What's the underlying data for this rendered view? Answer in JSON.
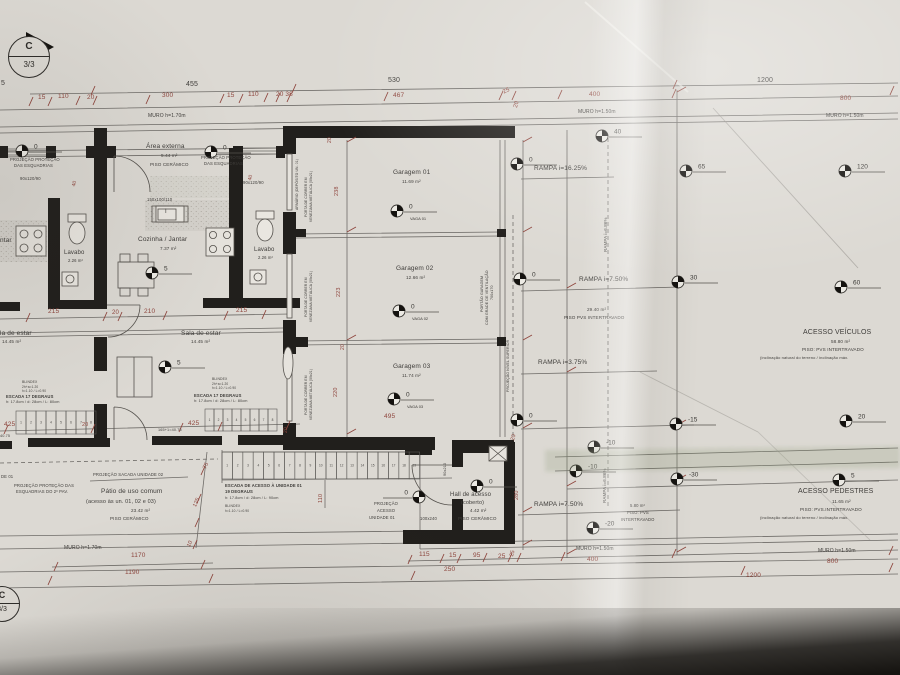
{
  "palette": {
    "paper": "#dcd9d3",
    "ink": "#3f3d3a",
    "red": "#94453c",
    "wall": "#1e1c19",
    "line": "#6e6b67"
  },
  "section_marker": {
    "top": "C",
    "bottom": "3/3"
  },
  "markers": [
    {
      "x": 22,
      "y": 151,
      "v": "0"
    },
    {
      "x": 211,
      "y": 152,
      "v": "0"
    },
    {
      "x": 152,
      "y": 273,
      "v": "5"
    },
    {
      "x": 165,
      "y": 367,
      "v": "5"
    },
    {
      "x": 397,
      "y": 211,
      "v": "0",
      "sub": "VAGA 01"
    },
    {
      "x": 399,
      "y": 311,
      "v": "0",
      "sub": "VAGA 02"
    },
    {
      "x": 394,
      "y": 399,
      "v": "0",
      "sub": "VAGA 03"
    },
    {
      "x": 517,
      "y": 164,
      "v": "0"
    },
    {
      "x": 602,
      "y": 136,
      "v": "40"
    },
    {
      "x": 686,
      "y": 171,
      "v": "65"
    },
    {
      "x": 845,
      "y": 171,
      "v": "120"
    },
    {
      "x": 520,
      "y": 279,
      "v": "0"
    },
    {
      "x": 678,
      "y": 282,
      "v": "30"
    },
    {
      "x": 841,
      "y": 287,
      "v": "60"
    },
    {
      "x": 517,
      "y": 420,
      "v": "0"
    },
    {
      "x": 676,
      "y": 424,
      "v": "-15"
    },
    {
      "x": 846,
      "y": 421,
      "v": "20"
    },
    {
      "x": 594,
      "y": 447,
      "v": "-10"
    },
    {
      "x": 576,
      "y": 471,
      "v": "-10"
    },
    {
      "x": 677,
      "y": 479,
      "v": "-30"
    },
    {
      "x": 839,
      "y": 480,
      "v": "5"
    },
    {
      "x": 593,
      "y": 528,
      "v": "-20"
    },
    {
      "x": 477,
      "y": 486,
      "v": "0"
    },
    {
      "x": 419,
      "y": 497,
      "v": "0",
      "dir": -1
    }
  ],
  "stairs": {
    "runs": [
      {
        "x": 16,
        "y": 411,
        "w": 10,
        "h": 23,
        "count": 8
      },
      {
        "x": 205,
        "y": 409,
        "w": 9,
        "h": 22,
        "count": 8
      },
      {
        "x": 222,
        "y": 452,
        "w": 10.4,
        "h": 27,
        "count": 19
      }
    ]
  },
  "labels": [
    {
      "n": "dim-total-455",
      "t": "455",
      "x": 186,
      "y": 81,
      "s": 7
    },
    {
      "n": "dim-total-530",
      "t": "530",
      "x": 388,
      "y": 77,
      "s": 7
    },
    {
      "n": "dim-total-1200",
      "t": "1200",
      "x": 757,
      "y": 77,
      "s": 7
    },
    {
      "n": "dim",
      "t": "15",
      "x": 38,
      "y": 95,
      "s": 6.5,
      "c": "r"
    },
    {
      "n": "dim",
      "t": "110",
      "x": 58,
      "y": 94,
      "s": 6.5,
      "c": "r"
    },
    {
      "n": "dim",
      "t": "20",
      "x": 87,
      "y": 95,
      "s": 6.5,
      "c": "r"
    },
    {
      "n": "dim",
      "t": "300",
      "x": 162,
      "y": 93,
      "s": 6.5,
      "c": "r"
    },
    {
      "n": "dim",
      "t": "15",
      "x": 227,
      "y": 93,
      "s": 6.5,
      "c": "r"
    },
    {
      "n": "dim",
      "t": "110",
      "x": 248,
      "y": 92,
      "s": 6.5,
      "c": "r"
    },
    {
      "n": "dim",
      "t": "20 38",
      "x": 276,
      "y": 92,
      "s": 6.5,
      "c": "r"
    },
    {
      "n": "dim",
      "t": "467",
      "x": 393,
      "y": 93,
      "s": 6.5,
      "c": "r"
    },
    {
      "n": "dim",
      "t": "25",
      "x": 502,
      "y": 90,
      "s": 6,
      "c": "r",
      "r": -25
    },
    {
      "n": "dim",
      "t": "20",
      "x": 513,
      "y": 107,
      "s": 6,
      "c": "r",
      "r": -75
    },
    {
      "n": "dim",
      "t": "400",
      "x": 589,
      "y": 92,
      "s": 6.5,
      "c": "r"
    },
    {
      "n": "dim",
      "t": "800",
      "x": 840,
      "y": 96,
      "s": 6.5,
      "c": "r"
    },
    {
      "n": "wall-note",
      "t": "MURO h=1.70m",
      "x": 148,
      "y": 114,
      "s": 5
    },
    {
      "n": "wall-note",
      "t": "MURO h=1.50m",
      "x": 578,
      "y": 110,
      "s": 5
    },
    {
      "n": "wall-note",
      "t": "MURO h=1.50m",
      "x": 826,
      "y": 114,
      "s": 5
    },
    {
      "n": "dim-fragment",
      "t": "5",
      "x": 1,
      "y": 80,
      "s": 7
    },
    {
      "n": "note",
      "t": "PROJEÇÃO PROTEÇÃO",
      "x": 10,
      "y": 158,
      "s": 4.2
    },
    {
      "n": "note",
      "t": "DAS ESQUADRIAS",
      "x": 14,
      "y": 164,
      "s": 4.2
    },
    {
      "n": "window-code",
      "t": "90x120/90",
      "x": 20,
      "y": 177,
      "s": 4.2
    },
    {
      "n": "dim",
      "t": "40",
      "x": 72,
      "y": 186,
      "s": 5,
      "c": "r",
      "r": -75
    },
    {
      "n": "room-area-externa",
      "t": "Área externa",
      "x": 146,
      "y": 144,
      "s": 6.5
    },
    {
      "n": "room-area",
      "t": "5.44 m²",
      "x": 161,
      "y": 154,
      "s": 4.6
    },
    {
      "n": "floor-note",
      "t": "PISO CERÂMICO",
      "x": 150,
      "y": 163,
      "s": 4.6
    },
    {
      "n": "note",
      "t": "PROJEÇÃO PROTEÇÃO",
      "x": 201,
      "y": 156,
      "s": 4.2
    },
    {
      "n": "note",
      "t": "DAS ESQUADRIAS",
      "x": 204,
      "y": 162,
      "s": 4.2
    },
    {
      "n": "dim",
      "t": "40",
      "x": 248,
      "y": 180,
      "s": 5,
      "c": "r",
      "r": -75
    },
    {
      "n": "window-code",
      "t": "90x120/90",
      "x": 243,
      "y": 181,
      "s": 4.2
    },
    {
      "n": "window-code",
      "t": "150x100/110",
      "x": 147,
      "y": 198,
      "s": 4.2
    },
    {
      "n": "window-tag",
      "t": "I",
      "x": 165,
      "y": 209,
      "s": 6
    },
    {
      "n": "note",
      "t": "ARMÁRIO (DEPÓSITO UN. 01)",
      "x": 296,
      "y": 210,
      "s": 3.4,
      "r": -90
    },
    {
      "n": "room-cozinha",
      "t": "Cozinha / Jantar",
      "x": 138,
      "y": 237,
      "s": 6.5
    },
    {
      "n": "room-area",
      "t": "7.37 m²",
      "x": 160,
      "y": 247,
      "s": 4.6
    },
    {
      "n": "room-fragment",
      "t": "ntar",
      "x": 0,
      "y": 238,
      "s": 6.5
    },
    {
      "n": "room-lavabo",
      "t": "Lavabo",
      "x": 64,
      "y": 250,
      "s": 6
    },
    {
      "n": "room-area",
      "t": "2.26 m²",
      "x": 68,
      "y": 259,
      "s": 4.2
    },
    {
      "n": "room-lavabo",
      "t": "Lavabo",
      "x": 254,
      "y": 247,
      "s": 6
    },
    {
      "n": "room-area",
      "t": "2.26 m²",
      "x": 258,
      "y": 256,
      "s": 4.2
    },
    {
      "n": "dim",
      "t": "215",
      "x": 48,
      "y": 309,
      "s": 6.5,
      "c": "r"
    },
    {
      "n": "dim",
      "t": "20",
      "x": 112,
      "y": 310,
      "s": 6,
      "c": "r"
    },
    {
      "n": "dim",
      "t": "210",
      "x": 144,
      "y": 309,
      "s": 6.5,
      "c": "r"
    },
    {
      "n": "dim",
      "t": "215",
      "x": 236,
      "y": 308,
      "s": 6.5,
      "c": "r"
    },
    {
      "n": "room-fragment",
      "t": "la de estar",
      "x": 0,
      "y": 331,
      "s": 6.5
    },
    {
      "n": "room-area",
      "t": "14.45 m²",
      "x": 2,
      "y": 340,
      "s": 4.6
    },
    {
      "n": "room-sala",
      "t": "Sala de estar",
      "x": 181,
      "y": 331,
      "s": 6.5
    },
    {
      "n": "room-area",
      "t": "14.45 m²",
      "x": 191,
      "y": 340,
      "s": 4.6
    },
    {
      "n": "note",
      "t": "BLINDEX",
      "x": 22,
      "y": 381,
      "s": 3.4
    },
    {
      "n": "note",
      "t": "2h+a=1.20",
      "x": 22,
      "y": 386,
      "s": 3.2
    },
    {
      "n": "note",
      "t": "h=1.10 / L=0.90",
      "x": 22,
      "y": 390,
      "s": 3.2
    },
    {
      "n": "note",
      "t": "BLINDEX",
      "x": 212,
      "y": 378,
      "s": 3.4
    },
    {
      "n": "note",
      "t": "2h+a=1.20",
      "x": 212,
      "y": 383,
      "s": 3.2
    },
    {
      "n": "note",
      "t": "h=1.10 / L=0.90",
      "x": 212,
      "y": 387,
      "s": 3.2
    },
    {
      "n": "stair-note",
      "t": "ESCADA 17 DEGRAUS",
      "x": 6,
      "y": 395,
      "s": 4.2,
      "b": 1
    },
    {
      "n": "stair-note",
      "t": "h: 17.8cm / d: 28cm / L: 80cm",
      "x": 6,
      "y": 401,
      "s": 3.8
    },
    {
      "n": "stair-note",
      "t": "ESCADA 17 DEGRAUS",
      "x": 194,
      "y": 394,
      "s": 4.2,
      "b": 1
    },
    {
      "n": "stair-note",
      "t": "h: 17.8cm / d: 28cm / L: 80cm",
      "x": 194,
      "y": 400,
      "s": 3.8
    },
    {
      "n": "dim",
      "t": "425",
      "x": 4,
      "y": 422,
      "s": 6.5,
      "c": "r"
    },
    {
      "n": "dim",
      "t": "425",
      "x": 188,
      "y": 421,
      "s": 6.5,
      "c": "r"
    },
    {
      "n": "dim",
      "t": "20",
      "x": 82,
      "y": 423,
      "s": 5.5,
      "c": "r"
    },
    {
      "n": "note",
      "t": "165+1=40.75",
      "x": 158,
      "y": 429,
      "s": 3.8
    },
    {
      "n": "note",
      "t": "40.75",
      "x": 0,
      "y": 435,
      "s": 3.8
    },
    {
      "n": "note-fragment",
      "t": "DE 01",
      "x": 1,
      "y": 475,
      "s": 4.2
    },
    {
      "n": "note",
      "t": "PROJEÇÃO PROTEÇÃO DAS",
      "x": 14,
      "y": 484,
      "s": 4.2
    },
    {
      "n": "note",
      "t": "ESQUADRIAS DO 2º PAV.",
      "x": 16,
      "y": 490,
      "s": 4.2
    },
    {
      "n": "note",
      "t": "PROJEÇÃO SACADA UNIDADE 02",
      "x": 93,
      "y": 473,
      "s": 4.2
    },
    {
      "n": "room-patio",
      "t": "Pátio de uso comum",
      "x": 101,
      "y": 489,
      "s": 6.5
    },
    {
      "n": "room-patio-sub",
      "t": "(acesso às un. 01, 02 e 03)",
      "x": 86,
      "y": 500,
      "s": 5.5
    },
    {
      "n": "room-area",
      "t": "23.42 m²",
      "x": 131,
      "y": 509,
      "s": 4.6
    },
    {
      "n": "floor-note",
      "t": "PISO CERÂMICO",
      "x": 110,
      "y": 517,
      "s": 4.6
    },
    {
      "n": "dim",
      "t": "75",
      "x": 203,
      "y": 468,
      "s": 5.5,
      "c": "r",
      "r": -65
    },
    {
      "n": "dim",
      "t": "125",
      "x": 193,
      "y": 506,
      "s": 5.5,
      "c": "r",
      "r": -65
    },
    {
      "n": "dim",
      "t": "10",
      "x": 187,
      "y": 546,
      "s": 5.5,
      "c": "r",
      "r": -65
    },
    {
      "n": "wall-note",
      "t": "MURO h=1.70m",
      "x": 64,
      "y": 546,
      "s": 5
    },
    {
      "n": "dim",
      "t": "1170",
      "x": 131,
      "y": 553,
      "s": 6.5,
      "c": "r"
    },
    {
      "n": "dim",
      "t": "1190",
      "x": 125,
      "y": 570,
      "s": 6.5,
      "c": "r"
    },
    {
      "n": "stair-note",
      "t": "ESCADA DE ACESSO À UNIDADE 01",
      "x": 225,
      "y": 484,
      "s": 4.2,
      "b": 1
    },
    {
      "n": "stair-note",
      "t": "19 DEGRAUS",
      "x": 225,
      "y": 490,
      "s": 4.2,
      "b": 1
    },
    {
      "n": "stair-note",
      "t": "h: 17.8cm / d: 28cm / L: 90cm",
      "x": 225,
      "y": 497,
      "s": 3.8
    },
    {
      "n": "note",
      "t": "BLINDEX",
      "x": 225,
      "y": 505,
      "s": 3.4
    },
    {
      "n": "note",
      "t": "h=1.10 / L=0.90",
      "x": 225,
      "y": 510,
      "s": 3.2
    },
    {
      "n": "dim",
      "t": "110",
      "x": 319,
      "y": 503,
      "s": 5.5,
      "c": "r",
      "r": -90
    },
    {
      "n": "note",
      "t": "PROJEÇÃO",
      "x": 374,
      "y": 502,
      "s": 4.2
    },
    {
      "n": "note",
      "t": "ACESSO",
      "x": 377,
      "y": 509,
      "s": 4.2
    },
    {
      "n": "note",
      "t": "UNIDADE 01",
      "x": 369,
      "y": 516,
      "s": 4.2
    },
    {
      "n": "door-code",
      "t": "100x240",
      "x": 420,
      "y": 517,
      "s": 4.2
    },
    {
      "n": "door-code",
      "t": "90x210",
      "x": 444,
      "y": 476,
      "s": 3.8,
      "r": -90
    },
    {
      "n": "room-hall",
      "t": "Hall de acesso",
      "x": 450,
      "y": 492,
      "s": 6
    },
    {
      "n": "room-hall-sub",
      "t": "(coberto)",
      "x": 461,
      "y": 501,
      "s": 5.5
    },
    {
      "n": "room-area",
      "t": "4.42 m²",
      "x": 470,
      "y": 509,
      "s": 4.6
    },
    {
      "n": "floor-note",
      "t": "PISO CERÂMICO",
      "x": 458,
      "y": 517,
      "s": 4.6
    },
    {
      "n": "dim",
      "t": "280",
      "x": 515,
      "y": 500,
      "s": 5.5,
      "c": "r",
      "r": -90
    },
    {
      "n": "dim",
      "t": "20",
      "x": 511,
      "y": 440,
      "s": 5.5,
      "c": "r",
      "r": -75
    },
    {
      "n": "dim",
      "t": "25",
      "x": 510,
      "y": 556,
      "s": 5.5,
      "c": "r",
      "r": -75
    },
    {
      "n": "dim",
      "t": "115",
      "x": 419,
      "y": 552,
      "s": 6.5,
      "c": "r"
    },
    {
      "n": "dim",
      "t": "15",
      "x": 449,
      "y": 553,
      "s": 6.5,
      "c": "r"
    },
    {
      "n": "dim",
      "t": "95",
      "x": 473,
      "y": 553,
      "s": 6.5,
      "c": "r"
    },
    {
      "n": "dim",
      "t": "25",
      "x": 498,
      "y": 554,
      "s": 6.5,
      "c": "r"
    },
    {
      "n": "dim",
      "t": "250",
      "x": 444,
      "y": 567,
      "s": 6.5,
      "c": "r"
    },
    {
      "n": "wall-note",
      "t": "MURO h=1.50m",
      "x": 576,
      "y": 547,
      "s": 5
    },
    {
      "n": "dim",
      "t": "400",
      "x": 587,
      "y": 557,
      "s": 6.5,
      "c": "r"
    },
    {
      "n": "dim",
      "t": "1200",
      "x": 746,
      "y": 573,
      "s": 6.5,
      "c": "r"
    },
    {
      "n": "wall-note",
      "t": "MURO h=1.50m",
      "x": 818,
      "y": 549,
      "s": 5
    },
    {
      "n": "dim",
      "t": "800",
      "x": 827,
      "y": 559,
      "s": 6.5,
      "c": "r"
    },
    {
      "n": "room-garagem-01",
      "t": "Garagem 01",
      "x": 393,
      "y": 170,
      "s": 6.5
    },
    {
      "n": "room-area",
      "t": "11.69 m²",
      "x": 402,
      "y": 180,
      "s": 4.6
    },
    {
      "n": "room-garagem-02",
      "t": "Garagem 02",
      "x": 396,
      "y": 266,
      "s": 6.5
    },
    {
      "n": "room-area",
      "t": "12.66 m²",
      "x": 406,
      "y": 276,
      "s": 4.6
    },
    {
      "n": "room-garagem-03",
      "t": "Garagem 03",
      "x": 393,
      "y": 364,
      "s": 6.5
    },
    {
      "n": "room-area",
      "t": "11.74 m²",
      "x": 402,
      "y": 374,
      "s": 4.6
    },
    {
      "n": "dim",
      "t": "495",
      "x": 384,
      "y": 414,
      "s": 6.5,
      "c": "r"
    },
    {
      "n": "dim",
      "t": "238",
      "x": 335,
      "y": 196,
      "s": 5.5,
      "c": "r",
      "r": -90
    },
    {
      "n": "dim",
      "t": "223",
      "x": 337,
      "y": 297,
      "s": 5.5,
      "c": "r",
      "r": -90
    },
    {
      "n": "dim",
      "t": "20",
      "x": 341,
      "y": 350,
      "s": 5,
      "c": "r",
      "r": -90
    },
    {
      "n": "dim",
      "t": "220",
      "x": 334,
      "y": 397,
      "s": 5.5,
      "c": "r",
      "r": -90
    },
    {
      "n": "dim",
      "t": "20",
      "x": 284,
      "y": 433,
      "s": 5,
      "c": "r",
      "r": -90
    },
    {
      "n": "dim",
      "t": "20",
      "x": 328,
      "y": 143,
      "s": 5,
      "c": "r",
      "r": -90
    },
    {
      "n": "door-note",
      "t": "PORTA DE CORRER EM",
      "x": 305,
      "y": 217,
      "s": 3.3,
      "r": -90
    },
    {
      "n": "door-note",
      "t": "VENEZIANA METÁLICA (09x21)",
      "x": 310,
      "y": 222,
      "s": 3.3,
      "r": -90
    },
    {
      "n": "door-note",
      "t": "PORTA DE CORRER EM",
      "x": 305,
      "y": 317,
      "s": 3.3,
      "r": -90
    },
    {
      "n": "door-note",
      "t": "VENEZIANA METÁLICA (09x21)",
      "x": 310,
      "y": 322,
      "s": 3.3,
      "r": -90
    },
    {
      "n": "door-note",
      "t": "PORTA DE CORRER EM",
      "x": 305,
      "y": 415,
      "s": 3.3,
      "r": -90
    },
    {
      "n": "door-note",
      "t": "VENEZIANA METÁLICA (09x21)",
      "x": 310,
      "y": 420,
      "s": 3.3,
      "r": -90
    },
    {
      "n": "gate-note",
      "t": "PORTÃO GARAGEM",
      "x": 481,
      "y": 312,
      "s": 3.6,
      "r": -90
    },
    {
      "n": "gate-note",
      "t": "COM GRADE DE VENTILAÇÃO",
      "x": 486,
      "y": 325,
      "s": 3.6,
      "r": -90
    },
    {
      "n": "gate-note",
      "t": "700x170",
      "x": 491,
      "y": 300,
      "s": 3.6,
      "r": -90
    },
    {
      "n": "note",
      "t": "PROJEÇÃO NÍVEL SUPERIOR",
      "x": 507,
      "y": 392,
      "s": 3.5,
      "r": -90
    },
    {
      "n": "ramp-label",
      "t": "RAMPA i=16.25%",
      "x": 534,
      "y": 166,
      "s": 6.5
    },
    {
      "n": "ramp-label",
      "t": "RAMPA i=6.86%",
      "x": 604,
      "y": 252,
      "s": 4.5,
      "r": -90
    },
    {
      "n": "ramp-label",
      "t": "RAMPA i=7.50%",
      "x": 579,
      "y": 277,
      "s": 6.5
    },
    {
      "n": "room-area",
      "t": "29.40 m²",
      "x": 587,
      "y": 308,
      "s": 4.6
    },
    {
      "n": "floor-note",
      "t": "PISO PVS INTERTRAVADO",
      "x": 564,
      "y": 316,
      "s": 4.6
    },
    {
      "n": "ramp-label",
      "t": "RAMPA i=3.75%",
      "x": 538,
      "y": 360,
      "s": 6.5
    },
    {
      "n": "ramp-label",
      "t": "RAMPA i=6.86%",
      "x": 603,
      "y": 503,
      "s": 4.5,
      "r": -90
    },
    {
      "n": "ramp-label",
      "t": "RAMPA i=7.50%",
      "x": 534,
      "y": 502,
      "s": 6.5
    },
    {
      "n": "room-area",
      "t": "5.80 m²",
      "x": 630,
      "y": 504,
      "s": 4.2
    },
    {
      "n": "floor-note",
      "t": "PISO: PVS",
      "x": 627,
      "y": 511,
      "s": 4.2
    },
    {
      "n": "floor-note",
      "t": "INTERTRAVADO",
      "x": 621,
      "y": 518,
      "s": 4.2
    },
    {
      "n": "zone-acesso-veiculos",
      "t": "ACESSO VEÍCULOS",
      "x": 803,
      "y": 329,
      "s": 7
    },
    {
      "n": "room-area",
      "t": "58.80 m²",
      "x": 831,
      "y": 340,
      "s": 4.6
    },
    {
      "n": "floor-note",
      "t": "PISO: PVS INTERTRAVADO",
      "x": 802,
      "y": 348,
      "s": 4.6
    },
    {
      "n": "note",
      "t": "(inclinação natural do terreno / inclinação máx.",
      "x": 760,
      "y": 356,
      "s": 4
    },
    {
      "n": "zone-acesso-pedestres",
      "t": "ACESSO PEDESTRES",
      "x": 798,
      "y": 488,
      "s": 7
    },
    {
      "n": "room-area",
      "t": "11.65 m²",
      "x": 832,
      "y": 500,
      "s": 4.6
    },
    {
      "n": "floor-note",
      "t": "PISO: PVS.INTERTRAVADO",
      "x": 800,
      "y": 508,
      "s": 4.6
    },
    {
      "n": "note",
      "t": "(inclinação natural do terreno / inclinação máx.",
      "x": 760,
      "y": 516,
      "s": 4
    }
  ]
}
